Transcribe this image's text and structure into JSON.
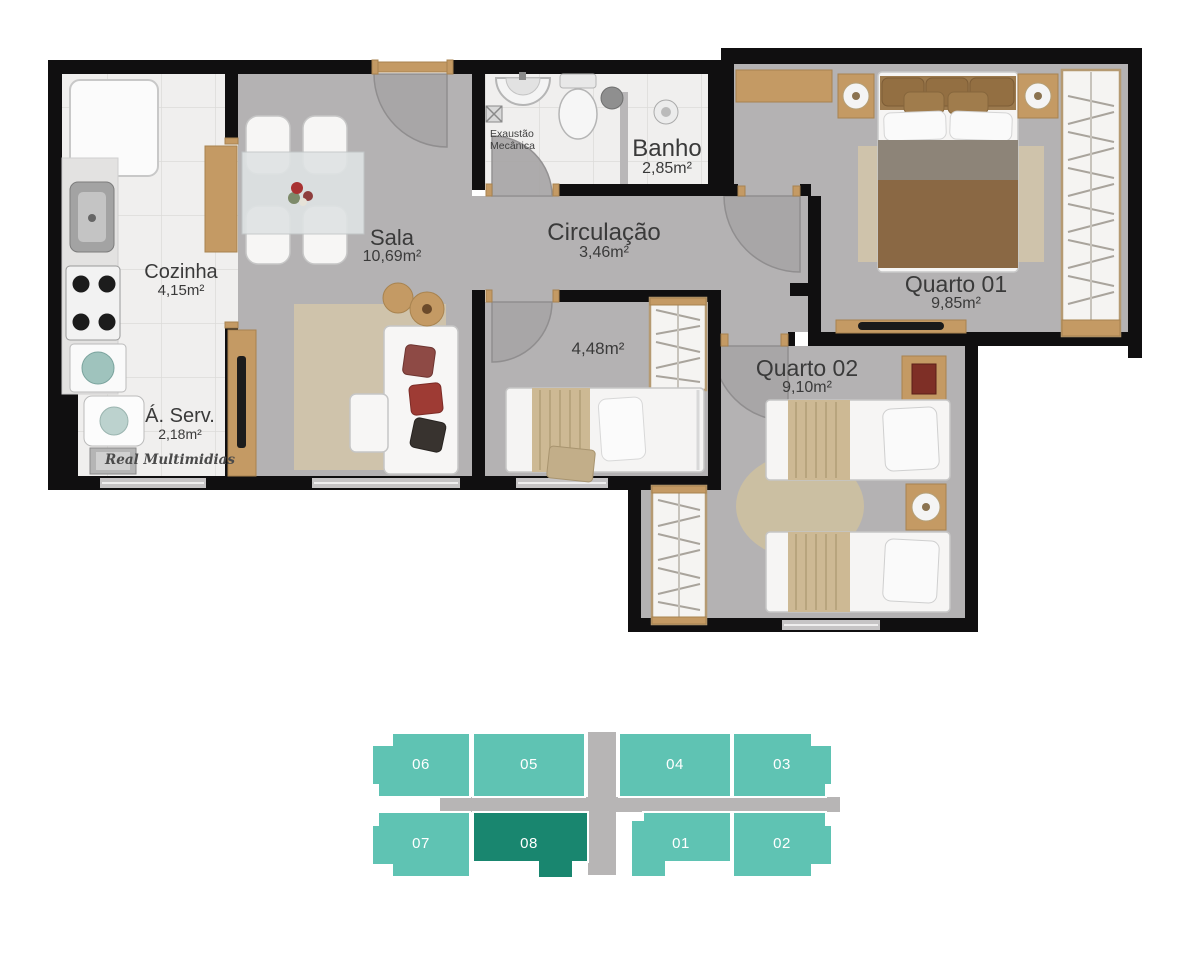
{
  "rooms": {
    "cozinha": {
      "name": "Cozinha",
      "area": "4,15m²"
    },
    "sala": {
      "name": "Sala",
      "area": "10,69m²"
    },
    "banho": {
      "name": "Banho",
      "area": "2,85m²"
    },
    "circulacao": {
      "name": "Circulação",
      "area": "3,46m²"
    },
    "quarto1": {
      "name": "Quarto 01",
      "area": "9,85m²"
    },
    "quarto2": {
      "name": "Quarto 02",
      "area": "9,10m²"
    },
    "reversivel": {
      "area": "4,48m²"
    },
    "aserv": {
      "name": "Á. Serv.",
      "area": "2,18m²"
    }
  },
  "notes": {
    "exhaust_line1": "Exaustão",
    "exhaust_line2": "Mecânica"
  },
  "watermark": "Real Multimidias",
  "keyplan": {
    "units": [
      {
        "number": "06",
        "selected": false
      },
      {
        "number": "05",
        "selected": false
      },
      {
        "number": "04",
        "selected": false
      },
      {
        "number": "03",
        "selected": false
      },
      {
        "number": "07",
        "selected": false
      },
      {
        "number": "08",
        "selected": true
      },
      {
        "number": "01",
        "selected": false
      },
      {
        "number": "02",
        "selected": false
      }
    ]
  },
  "colors": {
    "wall_black": "#100f10",
    "floor_gray": "#b4b2b3",
    "tile_white": "#f0efee",
    "wood": "#c49a64",
    "unit_teal": "#5fc3b3",
    "unit_selected": "#19866f",
    "corridor_gray": "#b7b5b5",
    "label_text": "#3a3a3a"
  }
}
